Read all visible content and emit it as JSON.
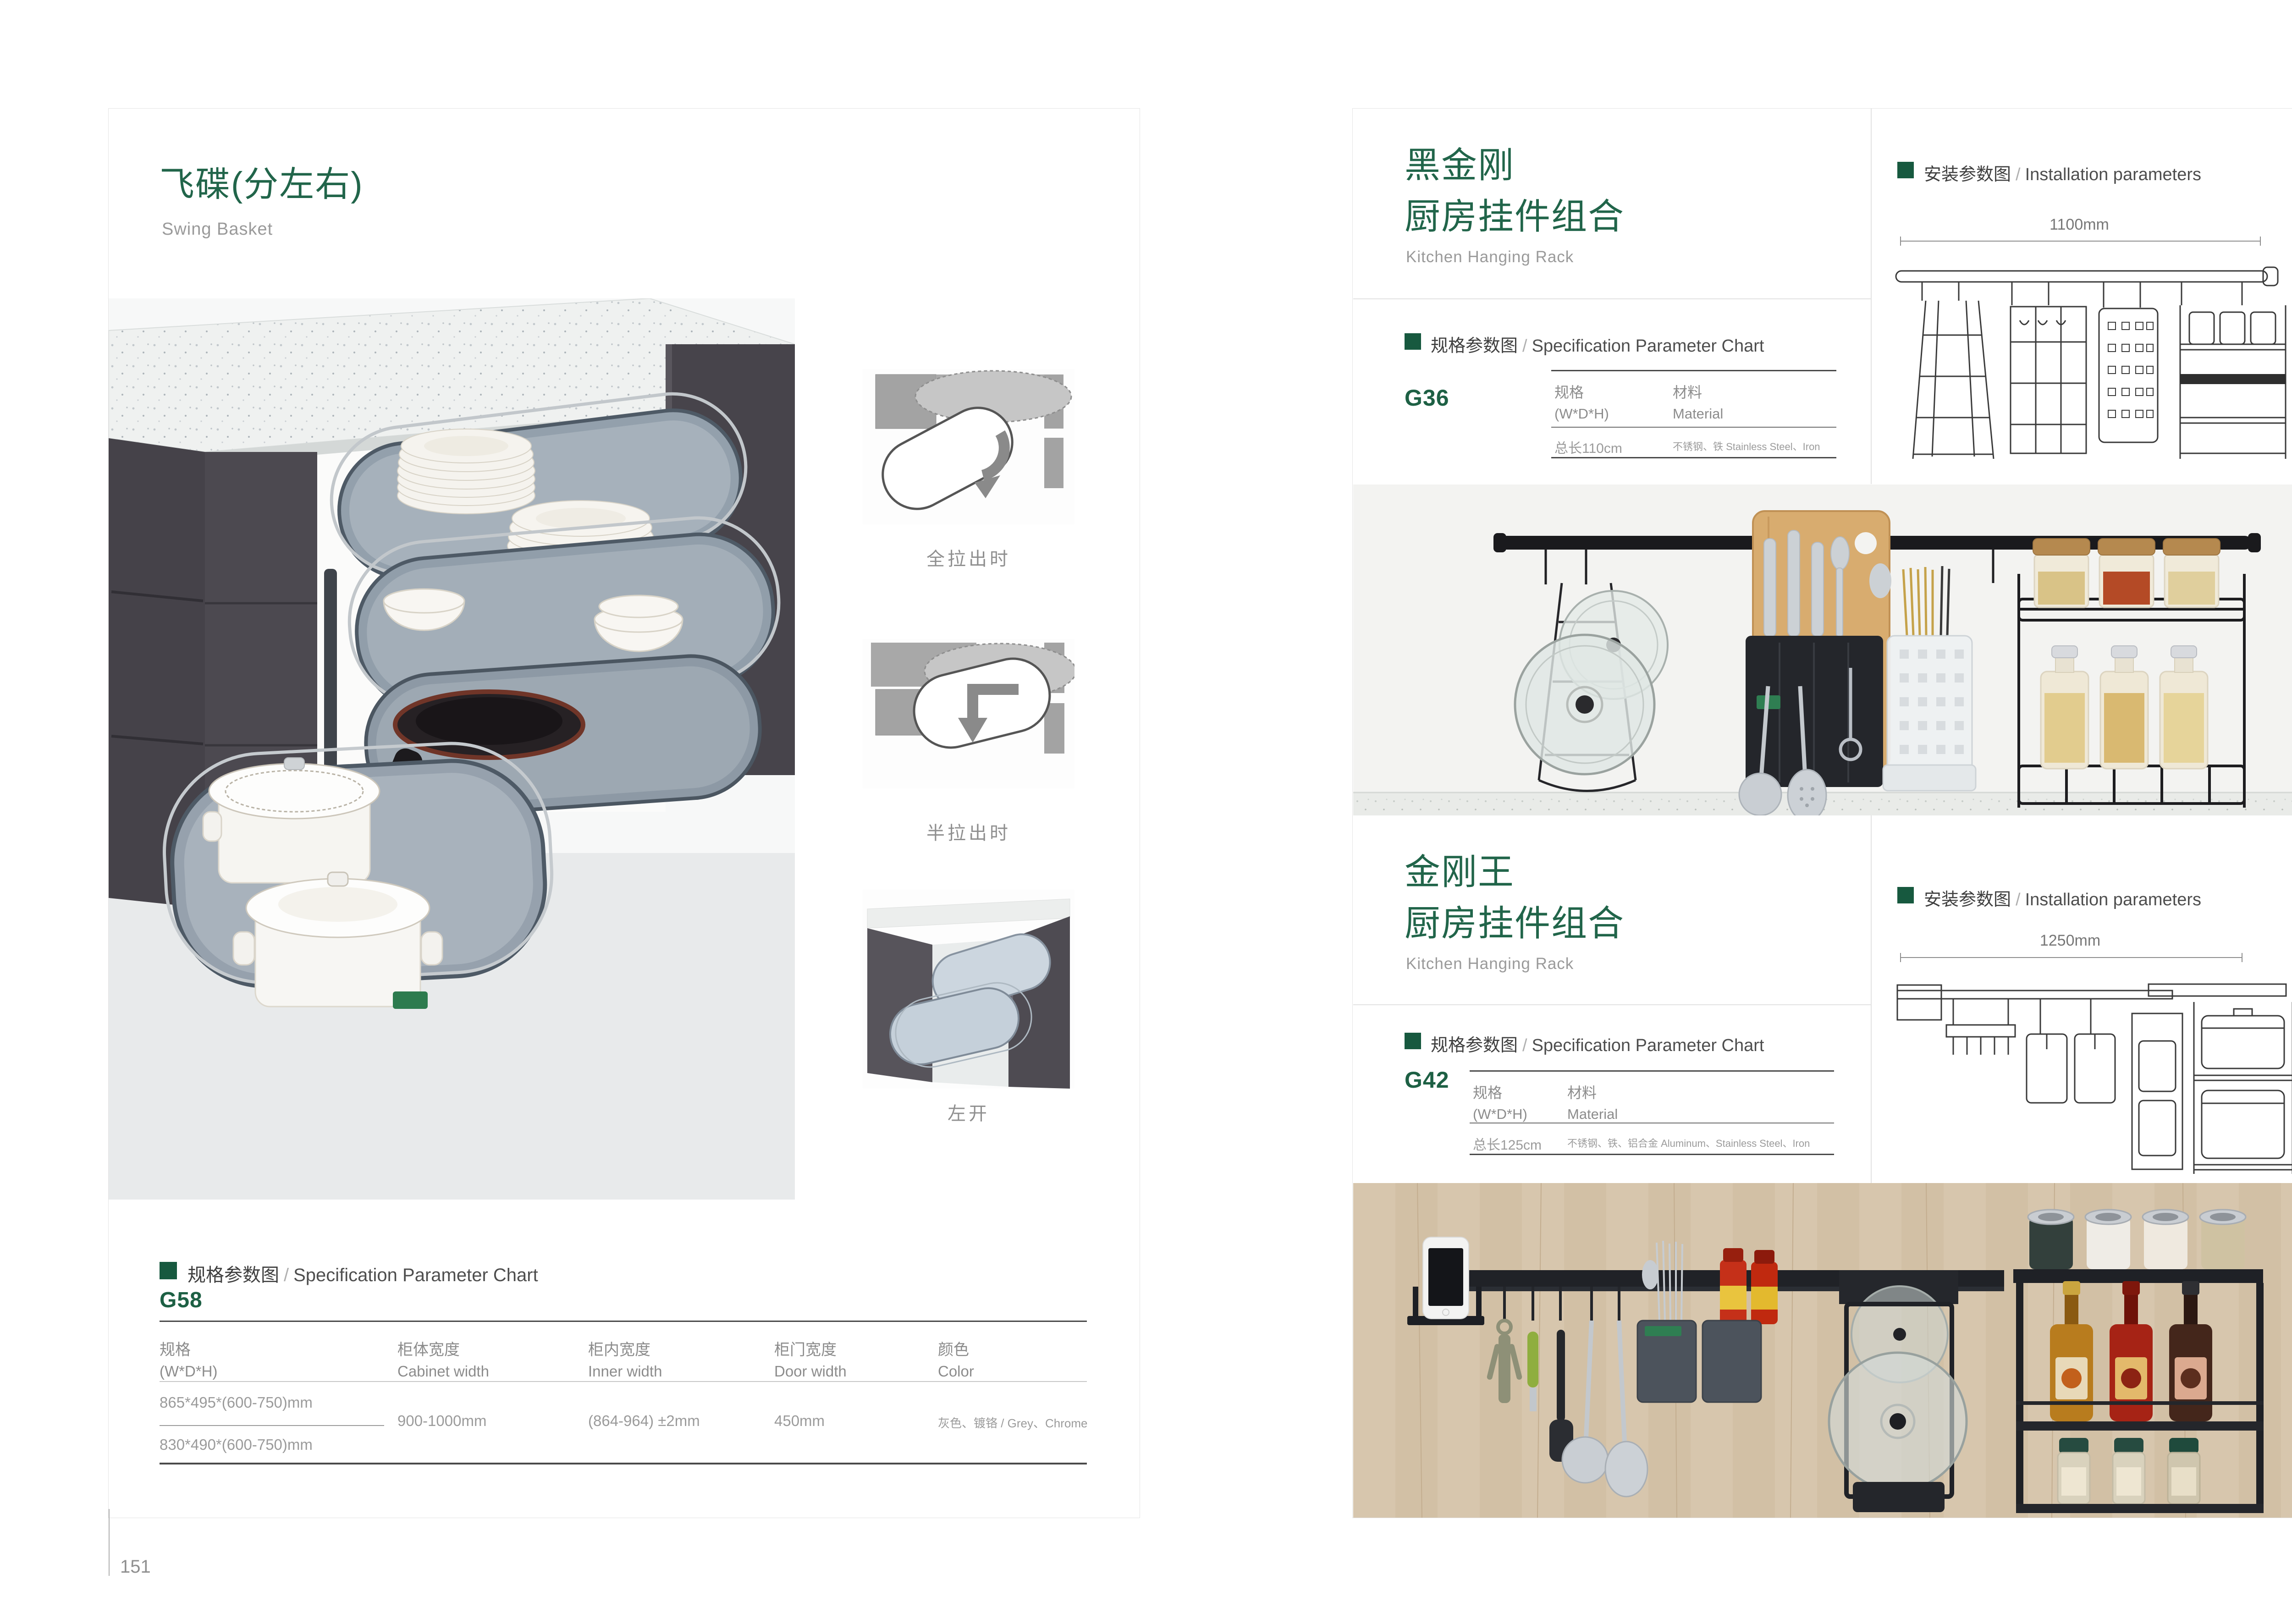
{
  "colors": {
    "accent_green": "#21654a",
    "accent_green_square": "#17593f",
    "gray_text": "#9a9a9a",
    "rail_black": "#1a1a1d",
    "wood": "#d7c6ad"
  },
  "left_page": {
    "page_number": "151",
    "title_cn": "飞碟(分左右)",
    "title_en": "Swing Basket",
    "thumb_labels": [
      "全拉出时",
      "半拉出时",
      "左开"
    ],
    "spec_header": {
      "cn": "规格参数图",
      "sep": "/",
      "en": "Specification Parameter Chart"
    },
    "model": "G58",
    "table": {
      "col1_cn": "规格",
      "col1_en": "(W*D*H)",
      "col2_cn": "柜体宽度",
      "col2_en": "Cabinet width",
      "col3_cn": "柜内宽度",
      "col3_en": "Inner width",
      "col4_cn": "柜门宽度",
      "col4_en": "Door width",
      "col5_cn": "颜色",
      "col5_en": "Color",
      "spec_a": "865*495*(600-750)mm",
      "spec_b": "830*490*(600-750)mm",
      "cabinet_width": "900-1000mm",
      "inner_width": "(864-964) ±2mm",
      "door_width": "450mm",
      "color": "灰色、镀铬 / Grey、Chrome"
    }
  },
  "right_page": {
    "page_number": "152",
    "product1": {
      "title_line1": "黑金刚",
      "title_line2": "厨房挂件组合",
      "title_en": "Kitchen Hanging Rack",
      "spec_header": {
        "cn": "规格参数图",
        "sep": "/",
        "en": "Specification Parameter Chart"
      },
      "model": "G36",
      "col1_cn": "规格",
      "col1_en": "(W*D*H)",
      "col2_cn": "材料",
      "col2_en": "Material",
      "val_size": "总长110cm",
      "val_material": "不锈钢、铁  Stainless Steel、Iron",
      "install_header": {
        "cn": "安装参数图",
        "sep": "/",
        "en": "Installation parameters"
      },
      "dim_width": "1100mm",
      "dim_height": "420mm"
    },
    "product2": {
      "title_line1": "金刚王",
      "title_line2": "厨房挂件组合",
      "title_en": "Kitchen Hanging Rack",
      "spec_header": {
        "cn": "规格参数图",
        "sep": "/",
        "en": "Specification Parameter Chart"
      },
      "model": "G42",
      "col1_cn": "规格",
      "col1_en": "(W*D*H)",
      "col2_cn": "材料",
      "col2_en": "Material",
      "val_size": "总长125cm",
      "val_material": "不锈钢、铁、铝合金  Aluminum、Stainless Steel、Iron",
      "install_header": {
        "cn": "安装参数图",
        "sep": "/",
        "en": "Installation parameters"
      },
      "dim_width": "1250mm",
      "dim_height": "430mm"
    }
  }
}
